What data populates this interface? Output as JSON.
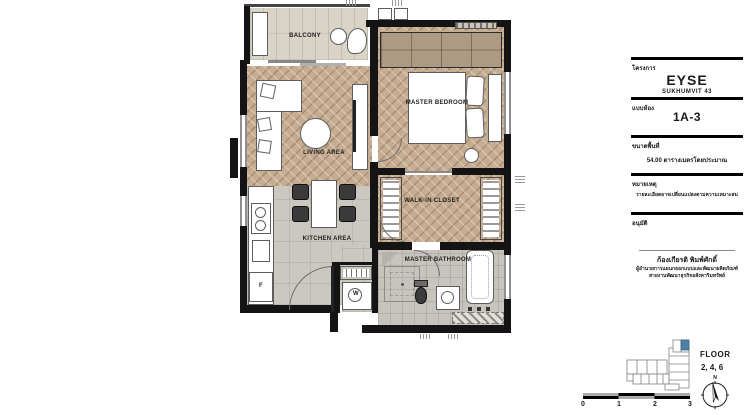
{
  "plan": {
    "rooms": {
      "balcony": "BALCONY",
      "master_bedroom": "MASTER BEDROOM",
      "living": "LIVING AREA",
      "kitchen": "KITCHEN AREA",
      "walkin_closet": "WALK-IN CLOSET",
      "master_bathroom": "MASTER BATHROOM"
    },
    "appliances": {
      "fridge": "F",
      "washer": "W"
    }
  },
  "titleblock": {
    "project_label": "โครงการ",
    "project_name": "EYSE",
    "project_sub": "SUKHUMVIT 43",
    "unit_label": "แบบห้อง",
    "unit_name": "1A-3",
    "area_label": "ขนาดพื้นที่",
    "area_value": "54.00 ตารางเมตรโดยประมาณ",
    "note_label": "หมายเหตุ",
    "note_text": "รายละเอียดอาจเปลี่ยนแปลงตามความเหมาะสม",
    "approve_label": "อนุมัติ",
    "approver_name": "ก้องเกียรติ พิมพ์ศักดิ์",
    "approver_title1": "ผู้อำนวยการแผนกออกแบบและพัฒนาผลิตภัณฑ์",
    "approver_title2": "สายงานพัฒนาธุรกิจอสังหาริมทรัพย์"
  },
  "keyplan": {
    "floor_label": "FLOOR",
    "floors": "2, 4, 6",
    "north": "N",
    "highlight_color": "#4e81a3"
  },
  "scalebar": {
    "ticks": [
      "0",
      "1",
      "2",
      "3"
    ]
  },
  "colors": {
    "wall": "#141414",
    "wood_floor": "#c6ac90",
    "tile_floor": "#cbc8c1",
    "keyplan_highlight": "#4e81a3"
  }
}
